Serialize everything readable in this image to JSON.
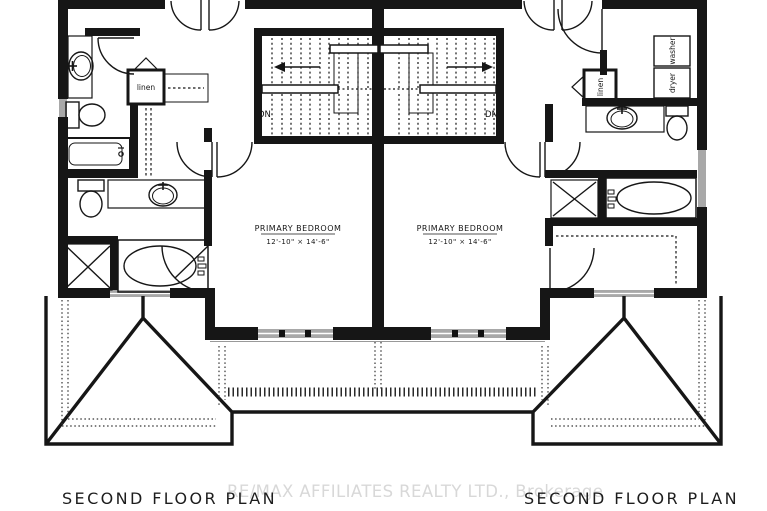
{
  "watermark": {
    "text": "RE/MAX AFFILIATES REALTY LTD., Brokerage",
    "color": "#d8d8d8"
  },
  "units": {
    "left": {
      "plan_title": "SECOND FLOOR PLAN",
      "room_label": "PRIMARY BEDROOM",
      "room_dims": "12'-10\" × 14'-6\"",
      "stair_label": "DN",
      "closet_label": "linen"
    },
    "right": {
      "plan_title": "SECOND FLOOR PLAN",
      "room_label": "PRIMARY BEDROOM",
      "room_dims": "12'-10\" × 14'-6\"",
      "stair_label": "DN",
      "closet_label": "linen",
      "washer_label": "washer",
      "dryer_label": "dryer"
    }
  },
  "colors": {
    "line": "#161616",
    "window_fill": "#a8a8a8",
    "background": "#ffffff"
  }
}
